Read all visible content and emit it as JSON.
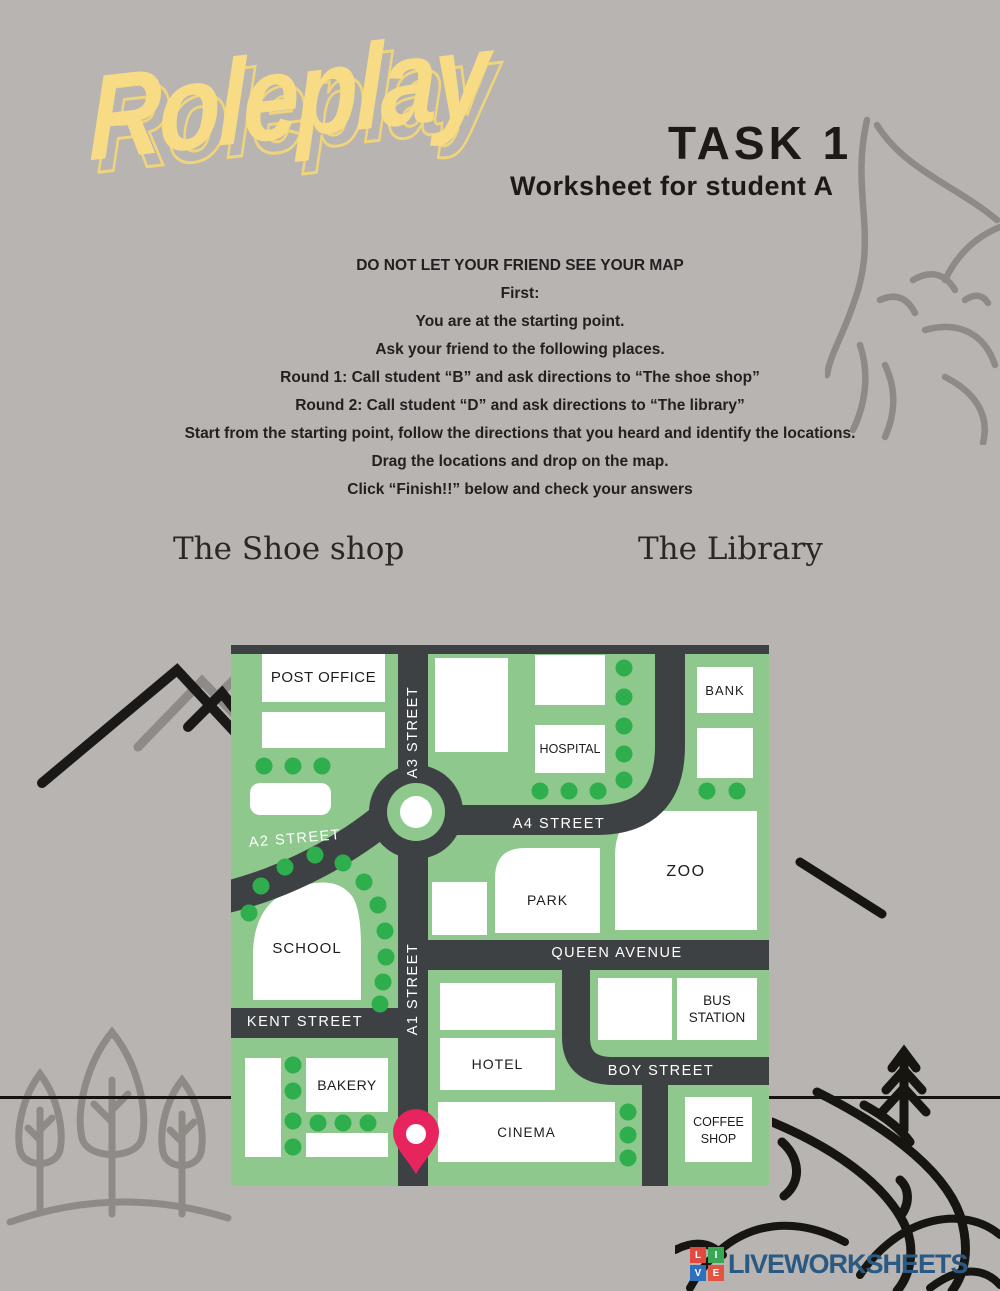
{
  "page": {
    "background": "#b8b4b1",
    "title": "Roleplay",
    "task_title": "TASK 1",
    "task_subtitle": "Worksheet for student A",
    "instructions": [
      "DO NOT LET YOUR FRIEND SEE YOUR MAP",
      "First:",
      "You are at the starting point.",
      "Ask your friend to the following places.",
      "Round 1: Call student “B” and ask directions to “The shoe shop”",
      "Round 2: Call student “D” and ask directions to “The library”",
      "Start from the starting point, follow the directions that you heard and identify the locations.",
      "Drag the locations and drop on the map.",
      "Click “Finish!!” below and check your answers"
    ],
    "draggables": [
      {
        "label": "The Shoe shop"
      },
      {
        "label": "The Library"
      }
    ]
  },
  "map": {
    "colors": {
      "ground": "#8ec88c",
      "road": "#3e4144",
      "building": "#ffffff",
      "tree_dot": "#2fae4d",
      "start_pin": "#e8245f"
    },
    "streets": {
      "a1": "A1 STREET",
      "a2": "A2 STREET",
      "a3": "A3 STREET",
      "a4": "A4 STREET",
      "queen": "QUEEN AVENUE",
      "kent": "KENT STREET",
      "boy": "BOY STREET"
    },
    "places": {
      "post_office": "POST OFFICE",
      "bank": "BANK",
      "hospital": "HOSPITAL",
      "park": "PARK",
      "zoo": "ZOO",
      "school": "SCHOOL",
      "bus_station": "BUS STATION",
      "hotel": "HOTEL",
      "bakery": "BAKERY",
      "cinema": "CINEMA",
      "coffee_shop": "COFFEE SHOP"
    }
  },
  "footer": {
    "brand": "LIVEWORKSHEETS",
    "brand_color": "#2a5a83",
    "logo_letters": [
      "L",
      "I",
      "V",
      "E"
    ]
  }
}
